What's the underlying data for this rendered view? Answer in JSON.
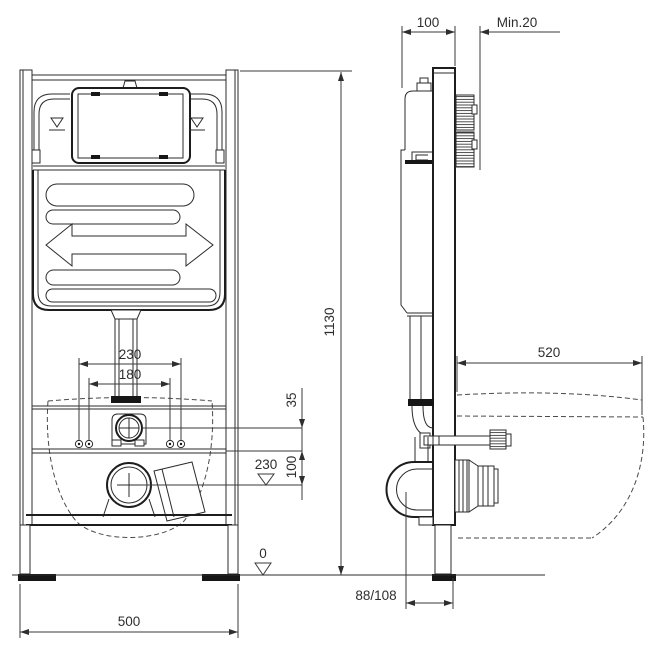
{
  "drawing": {
    "subject": "Concealed WC cistern installation frame — dimensional drawing, front and side view",
    "units": "mm",
    "line_color": "#2b2b2b",
    "background": "#ffffff",
    "dim": {
      "wall_offset": "100",
      "min_clearance": "Min.20",
      "frame_height": "1130",
      "fixing_spacing_outer": "230",
      "fixing_spacing_inner": "180",
      "flush_pipe_to_fixings": "35",
      "fixings_to_outlet": "100",
      "outlet_height": "230",
      "floor_level": "0",
      "frame_width": "500",
      "outlet_wall_distance": "88/108",
      "bowl_depth": "520"
    }
  }
}
